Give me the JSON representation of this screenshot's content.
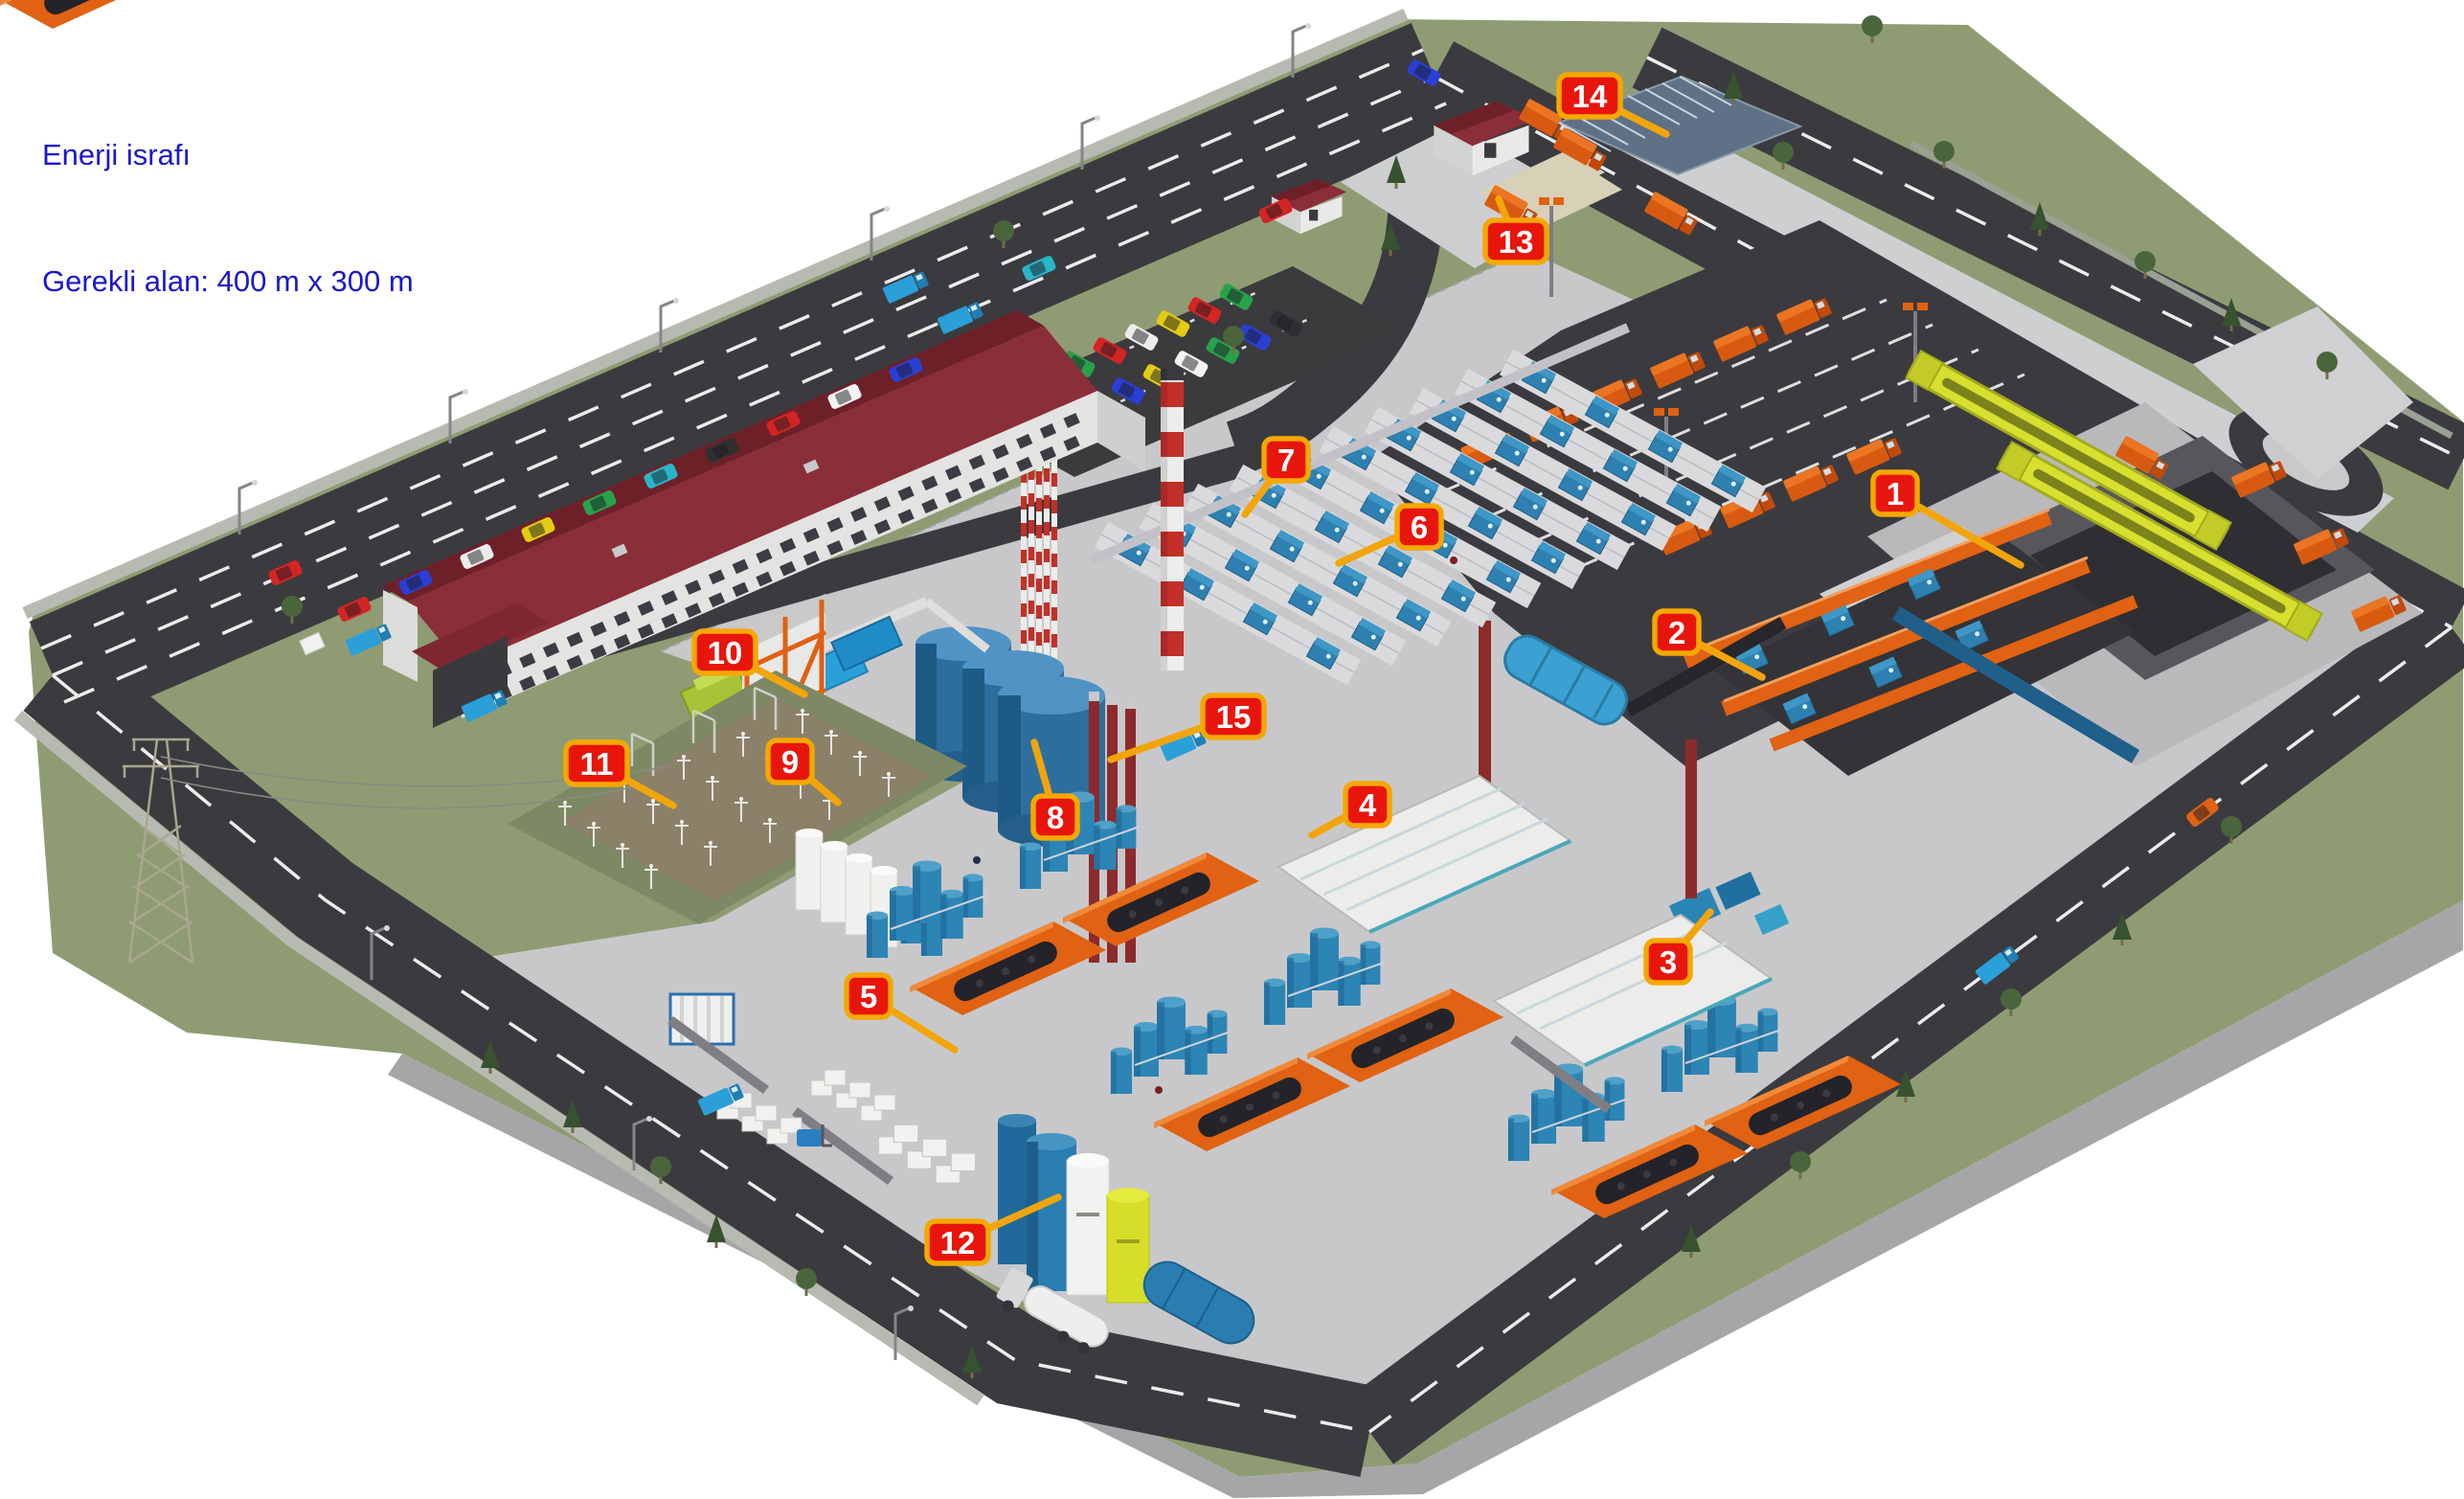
{
  "header": {
    "line1": "Enerji israfı",
    "line2": "Gerekli alan: 400 m x 300 m",
    "text_color": "#1a18cf"
  },
  "badges": [
    {
      "label": "1"
    },
    {
      "label": "2"
    },
    {
      "label": "3"
    },
    {
      "label": "4"
    },
    {
      "label": "5"
    },
    {
      "label": "6"
    },
    {
      "label": "7"
    },
    {
      "label": "8"
    },
    {
      "label": "9"
    },
    {
      "label": "10"
    },
    {
      "label": "11"
    },
    {
      "label": "12"
    },
    {
      "label": "13"
    },
    {
      "label": "14"
    },
    {
      "label": "15"
    }
  ],
  "colors": {
    "title_text": "#1a18cf",
    "badge_fill": "#e8150d",
    "badge_border": "#f5a800",
    "badge_text": "#ffffff",
    "leader_line": "#f2a50a",
    "grass": "#8f9c73",
    "asphalt": "#3b3b3f",
    "concrete": "#c8c8ca",
    "roof_red": "#7c2733",
    "machine_blue": "#2d80b0",
    "tank_blue": "#2c6e9e",
    "conveyor_orange": "#e06212",
    "crane_yellow": "#d7e02f"
  }
}
